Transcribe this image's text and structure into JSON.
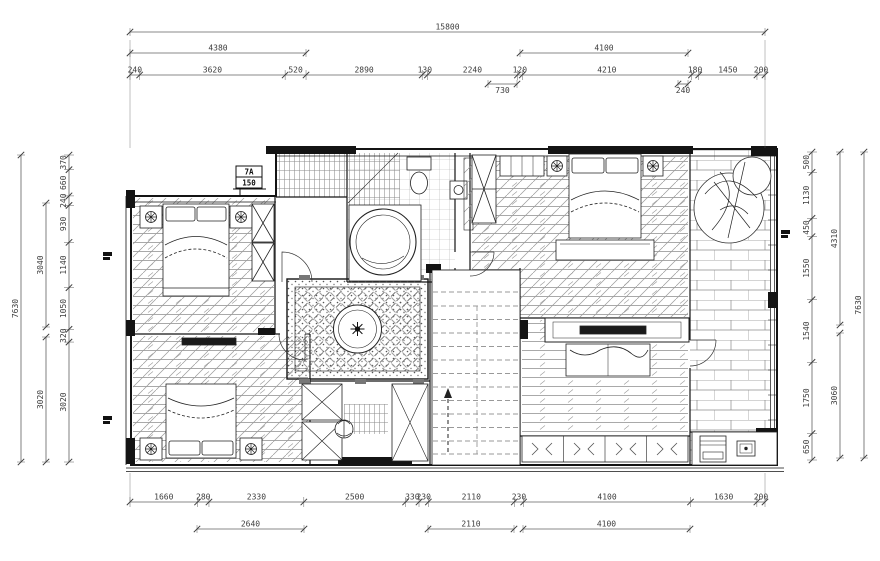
{
  "colors": {
    "ink": "#141414",
    "dim_line": "#606060",
    "dim_text": "#3c3c3c",
    "paper": "#ffffff",
    "pattern": "#8c8c8c"
  },
  "dimensions": {
    "top": {
      "overall": "15800",
      "group_left": "4380",
      "group_right": "4100",
      "chain": [
        "240",
        "3620",
        "520",
        "2890",
        "130",
        "2240",
        "120",
        "4210",
        "180",
        "1450",
        "200"
      ],
      "sub_left": "730",
      "sub_right": "240"
    },
    "bottom": {
      "chain": [
        "1660",
        "280",
        "2330",
        "2500",
        "330",
        "230",
        "2110",
        "230",
        "4100",
        "1630",
        "200"
      ],
      "groups": [
        "2640",
        "2110",
        "4100"
      ]
    },
    "left": {
      "overall": "7630",
      "groups": [
        "3040",
        "3020"
      ],
      "chain": [
        "370",
        "660",
        "240",
        "930",
        "1140",
        "1050",
        "320",
        "3020"
      ]
    },
    "right": {
      "overall": "7630",
      "groups": [
        "4310",
        "3060"
      ],
      "chain": [
        "500",
        "1130",
        "450",
        "1550",
        "1540",
        "1750",
        "650"
      ]
    }
  },
  "plan": {
    "marker": {
      "line1": "7A",
      "line2": "150"
    }
  }
}
